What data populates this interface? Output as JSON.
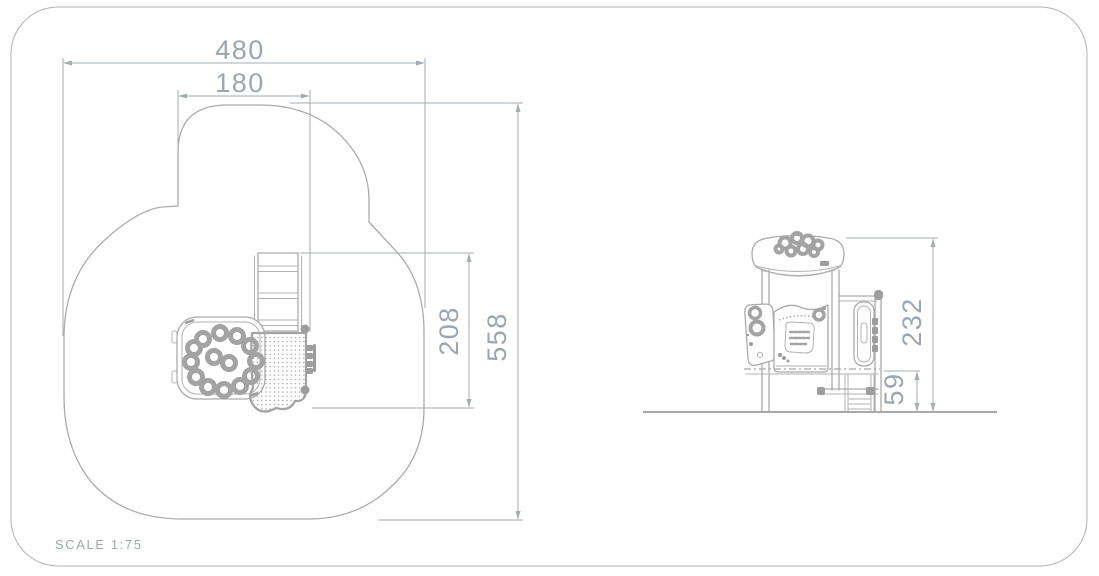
{
  "drawing": {
    "scale_label": "SCALE 1:75",
    "plan_view": {
      "dim_overall_width": "480",
      "dim_tower_width": "180",
      "dim_inner_depth": "208",
      "dim_overall_depth": "558"
    },
    "elevation_view": {
      "dim_overall_height": "232",
      "dim_platform_height": "59"
    },
    "colors": {
      "outline": "#ababab",
      "dimension_line": "#a6adb4",
      "dimension_text": "#9da6b0",
      "border": "#bcbcbc"
    }
  }
}
